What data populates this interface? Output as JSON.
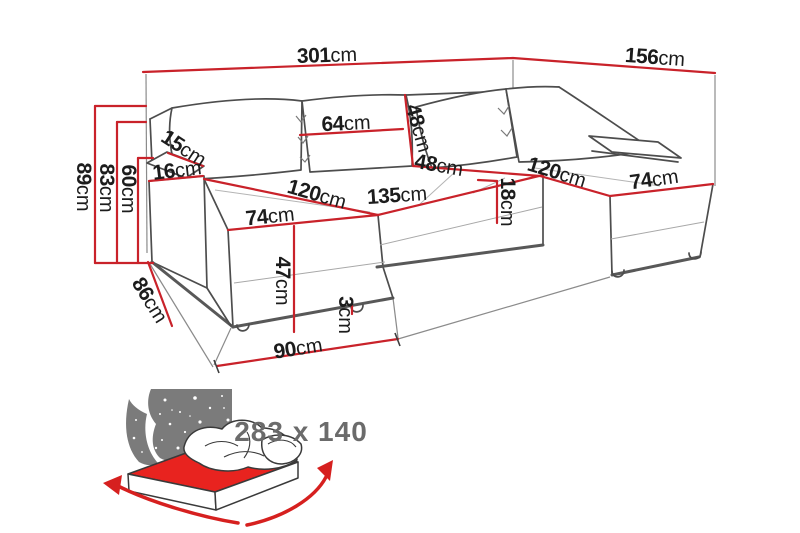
{
  "diagram": {
    "title": "sofa-dimension-diagram",
    "unit": "cm",
    "dims": {
      "total_width": {
        "v": "301",
        "u": "cm"
      },
      "total_depth": {
        "v": "156",
        "u": "cm"
      },
      "height_total": {
        "v": "89",
        "u": "cm"
      },
      "height_backrest": {
        "v": "83",
        "u": "cm"
      },
      "height_armrest": {
        "v": "60",
        "u": "cm"
      },
      "armrest_top": {
        "v": "15",
        "u": "cm"
      },
      "armrest_front": {
        "v": "16",
        "u": "cm"
      },
      "back_cushion_width": {
        "v": "64",
        "u": "cm"
      },
      "back_cushion_height": {
        "v": "48",
        "u": "cm"
      },
      "back_cushion_height2": {
        "v": "48",
        "u": "cm"
      },
      "chaise_left_length": {
        "v": "120",
        "u": "cm"
      },
      "chaise_left_width": {
        "v": "74",
        "u": "cm"
      },
      "middle_seat_width": {
        "v": "135",
        "u": "cm"
      },
      "seat_thickness": {
        "v": "18",
        "u": "cm"
      },
      "chaise_right_length": {
        "v": "120",
        "u": "cm"
      },
      "chaise_right_width": {
        "v": "74",
        "u": "cm"
      },
      "seat_height": {
        "v": "47",
        "u": "cm"
      },
      "leg_height": {
        "v": "3",
        "u": "cm"
      },
      "side_floor_depth": {
        "v": "86",
        "u": "cm"
      },
      "chaise_floor_width": {
        "v": "90",
        "u": "cm"
      }
    },
    "sleeping": {
      "label": "283 x 140"
    },
    "icons": {
      "bed_icon": "sofa-bed-function-icon"
    },
    "colors": {
      "dimension_red": "#c9222a",
      "outline_gray": "#4d4d4d",
      "label_black": "#1c1c1c",
      "sleep_text_gray": "#6b6b6b",
      "bed_red": "#e8231f",
      "night_gray": "#7b7b7b"
    }
  }
}
